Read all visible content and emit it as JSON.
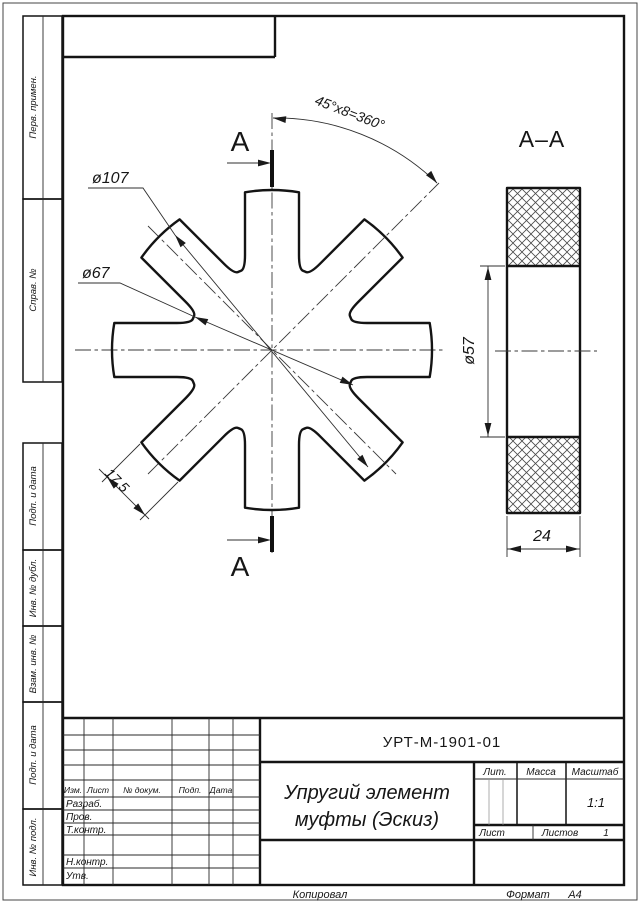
{
  "stamp": {
    "designation": "УРТ-М-1901-01",
    "title_line1": "Упругий элемент",
    "title_line2": "муфты (Эскиз)",
    "header": {
      "izm": "Изм.",
      "list": "Лист",
      "doc": "№ докум.",
      "podp": "Подп.",
      "data": "Дата"
    },
    "rows": {
      "razrab": "Разраб.",
      "prov": "Пров.",
      "tkontr": "Т.контр.",
      "nkontr": "Н.контр.",
      "utv": "Утв."
    },
    "right": {
      "lit": "Лит.",
      "massa": "Масса",
      "masshtab": "Масштаб",
      "scale_value": "1:1",
      "list": "Лист",
      "listov": "Листов",
      "listov_value": "1"
    }
  },
  "margins": {
    "perv": "Перв. примен.",
    "sprav": "Справ. №",
    "podp1": "Подп. и дата",
    "inv_dubl": "Инв. № дубл.",
    "vzam": "Взам. инв. №",
    "podp2": "Подп. и дата",
    "inv_podl": "Инв. № подл."
  },
  "footer": {
    "copied": "Копировал",
    "format_label": "Формат",
    "format_value": "А4"
  },
  "drawing": {
    "dim_d107": "ø107",
    "dim_d67": "ø67",
    "dim_tooth": "17,5",
    "dim_angle": "45°х8=360°",
    "section_letter": "А",
    "section_label": "А–А",
    "dim_d57": "ø57",
    "dim_24": "24"
  }
}
